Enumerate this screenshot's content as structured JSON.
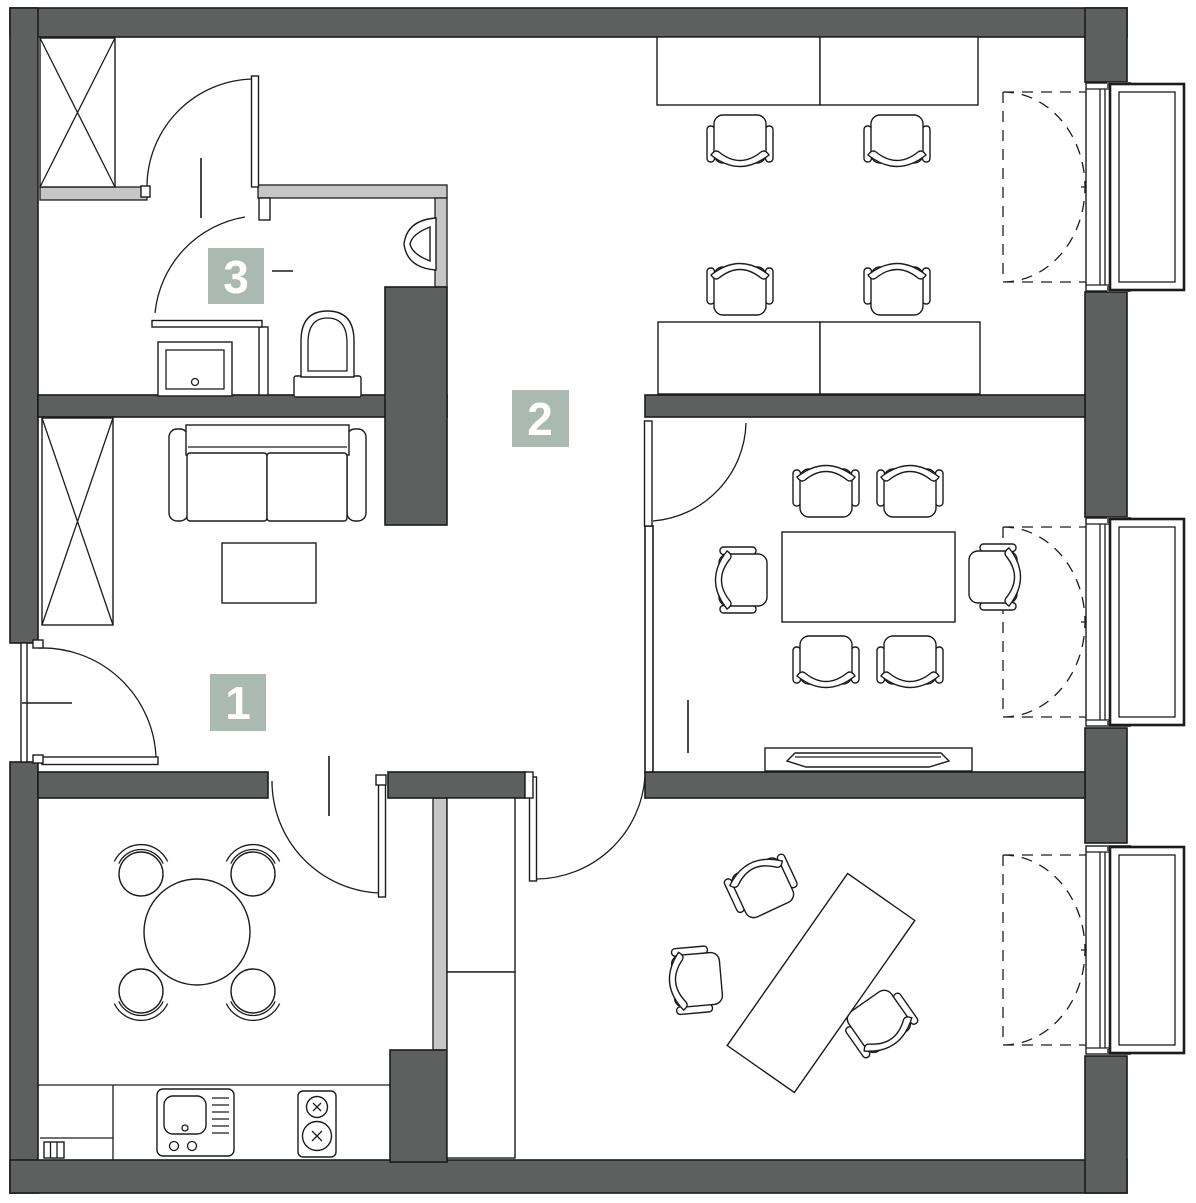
{
  "document": {
    "kind": "architectural-floor-plan",
    "style": "top-view office/apartment plan"
  },
  "labels": {
    "room1": "1",
    "room2": "2",
    "room3": "3"
  },
  "colors": {
    "wall": "#5e5f5f",
    "partition": "#c6c6c6",
    "outline": "#1c1c1c",
    "label-bg": "#aab9b1",
    "label-text": "#ffffff",
    "floor": "#ffffff"
  },
  "furniture_symbols": [
    "wardrobe-crossbox",
    "sofa",
    "coffee-table",
    "office-desk",
    "office-chair",
    "conference-table",
    "sideboard",
    "dining-table-round",
    "dining-chair",
    "kitchen-counter",
    "kitchen-sink",
    "cooktop",
    "bathroom-sink",
    "toilet",
    "urinal",
    "casement-window",
    "swing-door"
  ]
}
